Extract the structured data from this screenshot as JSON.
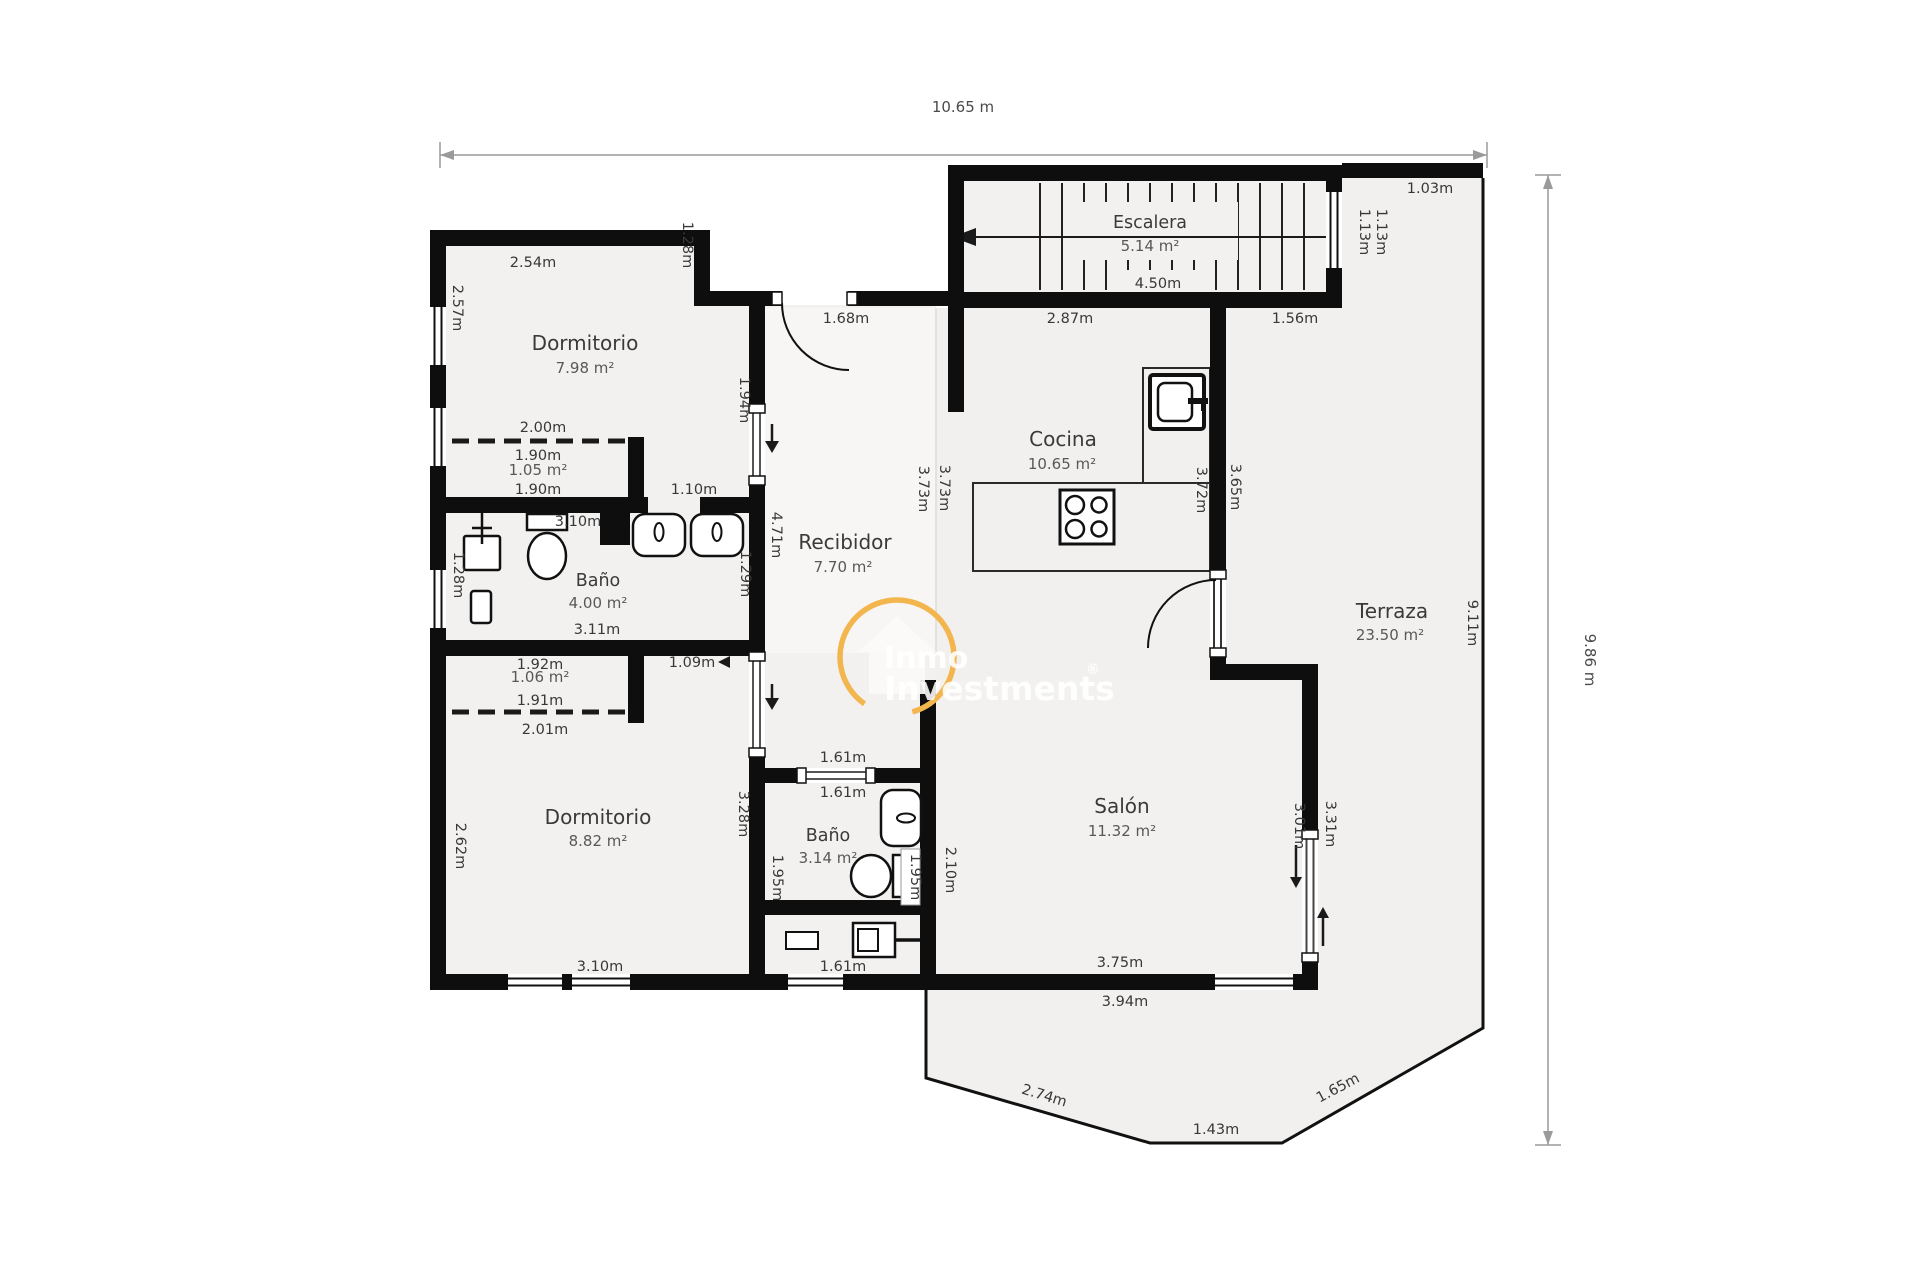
{
  "watermark": {
    "brand_top": "Inmo",
    "brand_bottom": "Investments",
    "registered": "®"
  },
  "dimensions": {
    "width_total": "10.65 m",
    "height_total": "9.86 m"
  },
  "rooms": {
    "dormitorio1": {
      "name": "Dormitorio",
      "area": "7.98 m²"
    },
    "bano1": {
      "name": "Baño",
      "area": "4.00 m²"
    },
    "closet1": {
      "area": "1.05 m²"
    },
    "closet2": {
      "area": "1.06 m²"
    },
    "dormitorio2": {
      "name": "Dormitorio",
      "area": "8.82 m²"
    },
    "bano2": {
      "name": "Baño",
      "area": "3.14 m²"
    },
    "recibidor": {
      "name": "Recibidor",
      "area": "7.70 m²"
    },
    "cocina": {
      "name": "Cocina",
      "area": "10.65 m²"
    },
    "salon": {
      "name": "Salón",
      "area": "11.32 m²"
    },
    "terraza": {
      "name": "Terraza",
      "area": "23.50 m²"
    },
    "escalera": {
      "name": "Escalera",
      "area": "5.14 m²"
    }
  },
  "measurements": {
    "m_2_54": "2.54m",
    "m_1_28_a": "1.28m",
    "m_2_57": "2.57m",
    "m_2_00": "2.00m",
    "m_1_90_a": "1.90m",
    "m_1_90_b": "1.90m",
    "m_3_10_a": "3.10m",
    "m_1_10": "1.10m",
    "m_1_28_b": "1.28m",
    "m_3_11": "3.11m",
    "m_1_29": "1.29m",
    "m_1_94": "1.94m",
    "m_4_71": "4.71m",
    "m_1_68": "1.68m",
    "m_3_73_a": "3.73m",
    "m_3_73_b": "3.73m",
    "m_4_50": "4.50m",
    "m_2_87": "2.87m",
    "m_1_56": "1.56m",
    "m_1_03": "1.03m",
    "m_1_13_a": "1.13m",
    "m_1_13_b": "1.13m",
    "m_3_72": "3.72m",
    "m_3_65": "3.65m",
    "m_9_11": "9.11m",
    "m_1_92": "1.92m",
    "m_1_91": "1.91m",
    "m_2_01": "2.01m",
    "m_1_09": "1.09m",
    "m_3_28": "3.28m",
    "m_2_62": "2.62m",
    "m_3_10_b": "3.10m",
    "m_1_61_a": "1.61m",
    "m_1_61_b": "1.61m",
    "m_1_61_c": "1.61m",
    "m_1_95_a": "1.95m",
    "m_1_95_b": "1.95m",
    "m_2_10": "2.10m",
    "m_3_01": "3.01m",
    "m_3_31": "3.31m",
    "m_3_75": "3.75m",
    "m_3_94": "3.94m",
    "m_2_74": "2.74m",
    "m_1_43": "1.43m",
    "m_1_65": "1.65m"
  }
}
